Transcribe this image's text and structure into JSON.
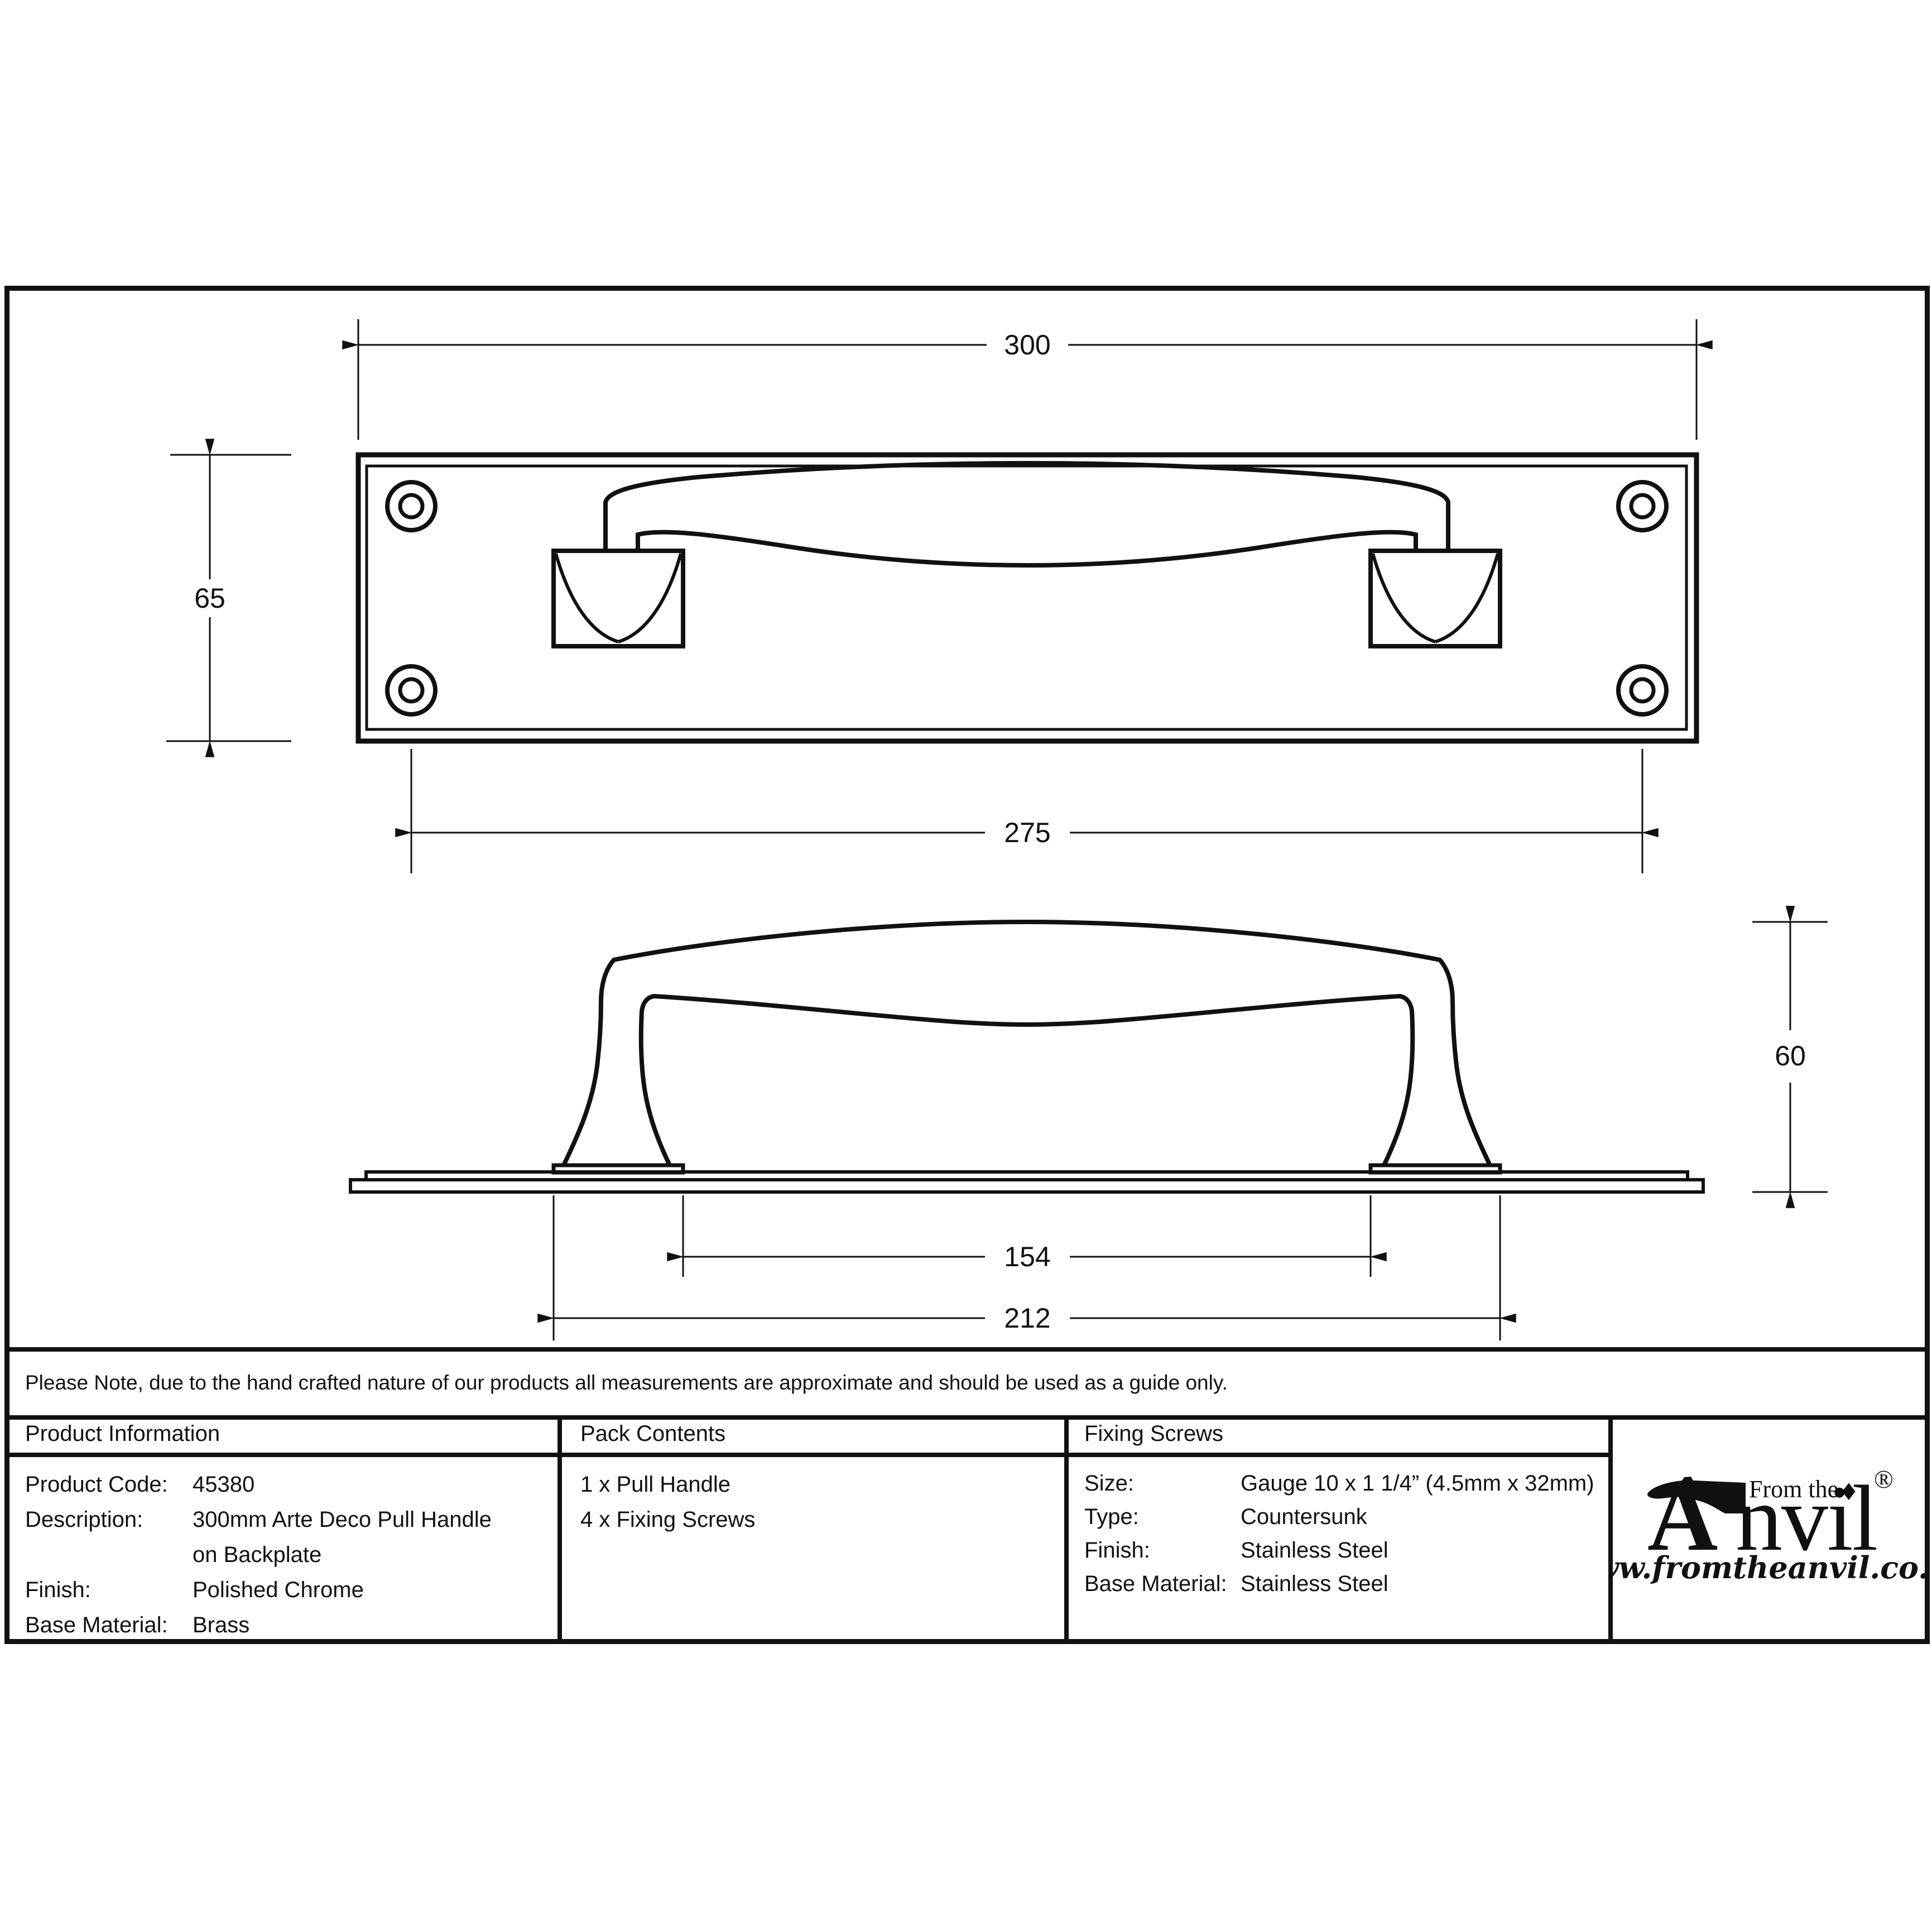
{
  "note": "Please Note, due to the hand crafted nature of our products all measurements are approximate and should be used as a guide only.",
  "dimensions": {
    "plate_width": "300",
    "plate_height": "65",
    "fixing_centres": "275",
    "handle_height": "60",
    "foot_inner_span": "154",
    "foot_outer_span": "212"
  },
  "product_information": {
    "header": "Product Information",
    "rows": [
      {
        "label": "Product Code:",
        "value": "45380"
      },
      {
        "label": "Description:",
        "value": "300mm Arte Deco Pull Handle"
      },
      {
        "label": "",
        "value": "on Backplate"
      },
      {
        "label": "Finish:",
        "value": "Polished Chrome"
      },
      {
        "label": "Base Material:",
        "value": "Brass"
      }
    ]
  },
  "pack_contents": {
    "header": "Pack Contents",
    "items": [
      "1 x Pull Handle",
      "4 x Fixing Screws"
    ]
  },
  "fixing_screws": {
    "header": "Fixing Screws",
    "rows": [
      {
        "label": "Size:",
        "value": "Gauge 10 x 1 1/4” (4.5mm x 32mm)"
      },
      {
        "label": "Type:",
        "value": "Countersunk"
      },
      {
        "label": "Finish:",
        "value": "Stainless Steel"
      },
      {
        "label": "Base Material:",
        "value": "Stainless Steel"
      }
    ]
  },
  "logo": {
    "from_the": "From the",
    "diamond": "♦",
    "wordmark_a": "A",
    "wordmark_rest": "nvil",
    "registered": "®",
    "website": "www.fromtheanvil.co.uk",
    "ink_color": "#111111"
  }
}
